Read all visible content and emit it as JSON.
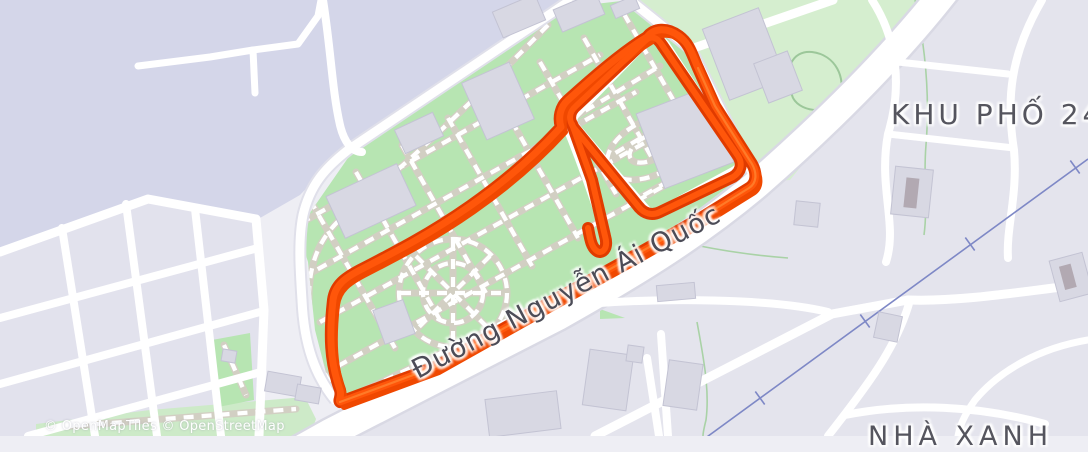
{
  "map": {
    "labels": {
      "district": "KHU PHỐ 24",
      "street": "Đường Nguyễn Ái Quốc",
      "place": "NHÀ XANH"
    },
    "attribution": "© OpenMapTiles © OpenStreetMap",
    "colors": {
      "water": "#d4d6e9",
      "park_green": "#b7e5b2",
      "light_green": "#d5eecf",
      "ground": "#eeeef4",
      "city_blocks": "#e2e2ed",
      "road": "#ffffff",
      "building": "#d8d8e3",
      "path_casing": "#d2cfc3",
      "route_orange": "#ff560a",
      "route_shadow": "#e03b00",
      "powerline_blue": "#7e88c6",
      "label_text": "#55555e"
    }
  }
}
